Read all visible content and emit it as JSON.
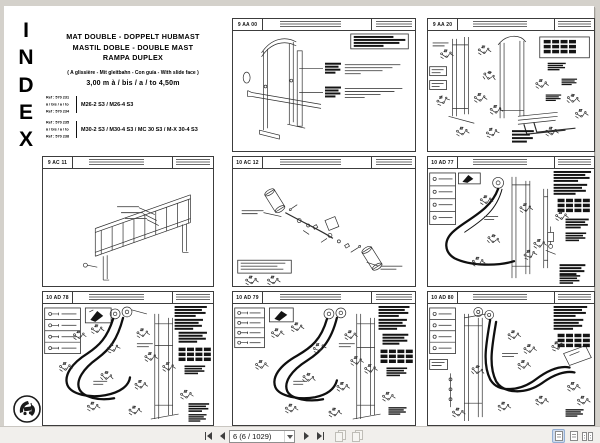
{
  "colors": {
    "window_bg": "#d4d1cb",
    "page_bg": "#ffffff",
    "selected_view_bg": "#cfdcef"
  },
  "index_panel": {
    "letters": [
      "I",
      "N",
      "D",
      "E",
      "X"
    ],
    "title_line1": "MAT DOUBLE - DOPPELT HUBMAST",
    "title_line2": "MASTIL DOBLE - DOUBLE MAST",
    "title_line3": "RAMPA DUPLEX",
    "subtitle": "( A glissière - Mit gleitbahn - Con guía - With slide face )",
    "range_label": "3,00 m à / bis / a / to 4,50m",
    "ref_groups": [
      {
        "ref_from": "Ref : 570 231",
        "ref_join": "à / bis / a / to",
        "ref_to": "Ref : 570 234",
        "models": "M26-2 S3 / M26-4 S3"
      },
      {
        "ref_from": "Ref : 570 235",
        "ref_join": "à / bis / a / to",
        "ref_to": "Ref : 570 238",
        "models": "M30-2 S3 / M30-4 S3 / MC 30 S3 / M-X 30-4 S3"
      }
    ]
  },
  "panels": [
    {
      "id": "9 AA 00"
    },
    {
      "id": "9 AA 20"
    },
    {
      "id": "9 AC 11"
    },
    {
      "id": "10 AC 12"
    },
    {
      "id": "10 AD 77"
    },
    {
      "id": "10 AD 78"
    },
    {
      "id": "10 AD 79"
    },
    {
      "id": "10 AD 80"
    }
  ],
  "toolbar": {
    "page_selector_value": "6 (6 / 1029)"
  }
}
